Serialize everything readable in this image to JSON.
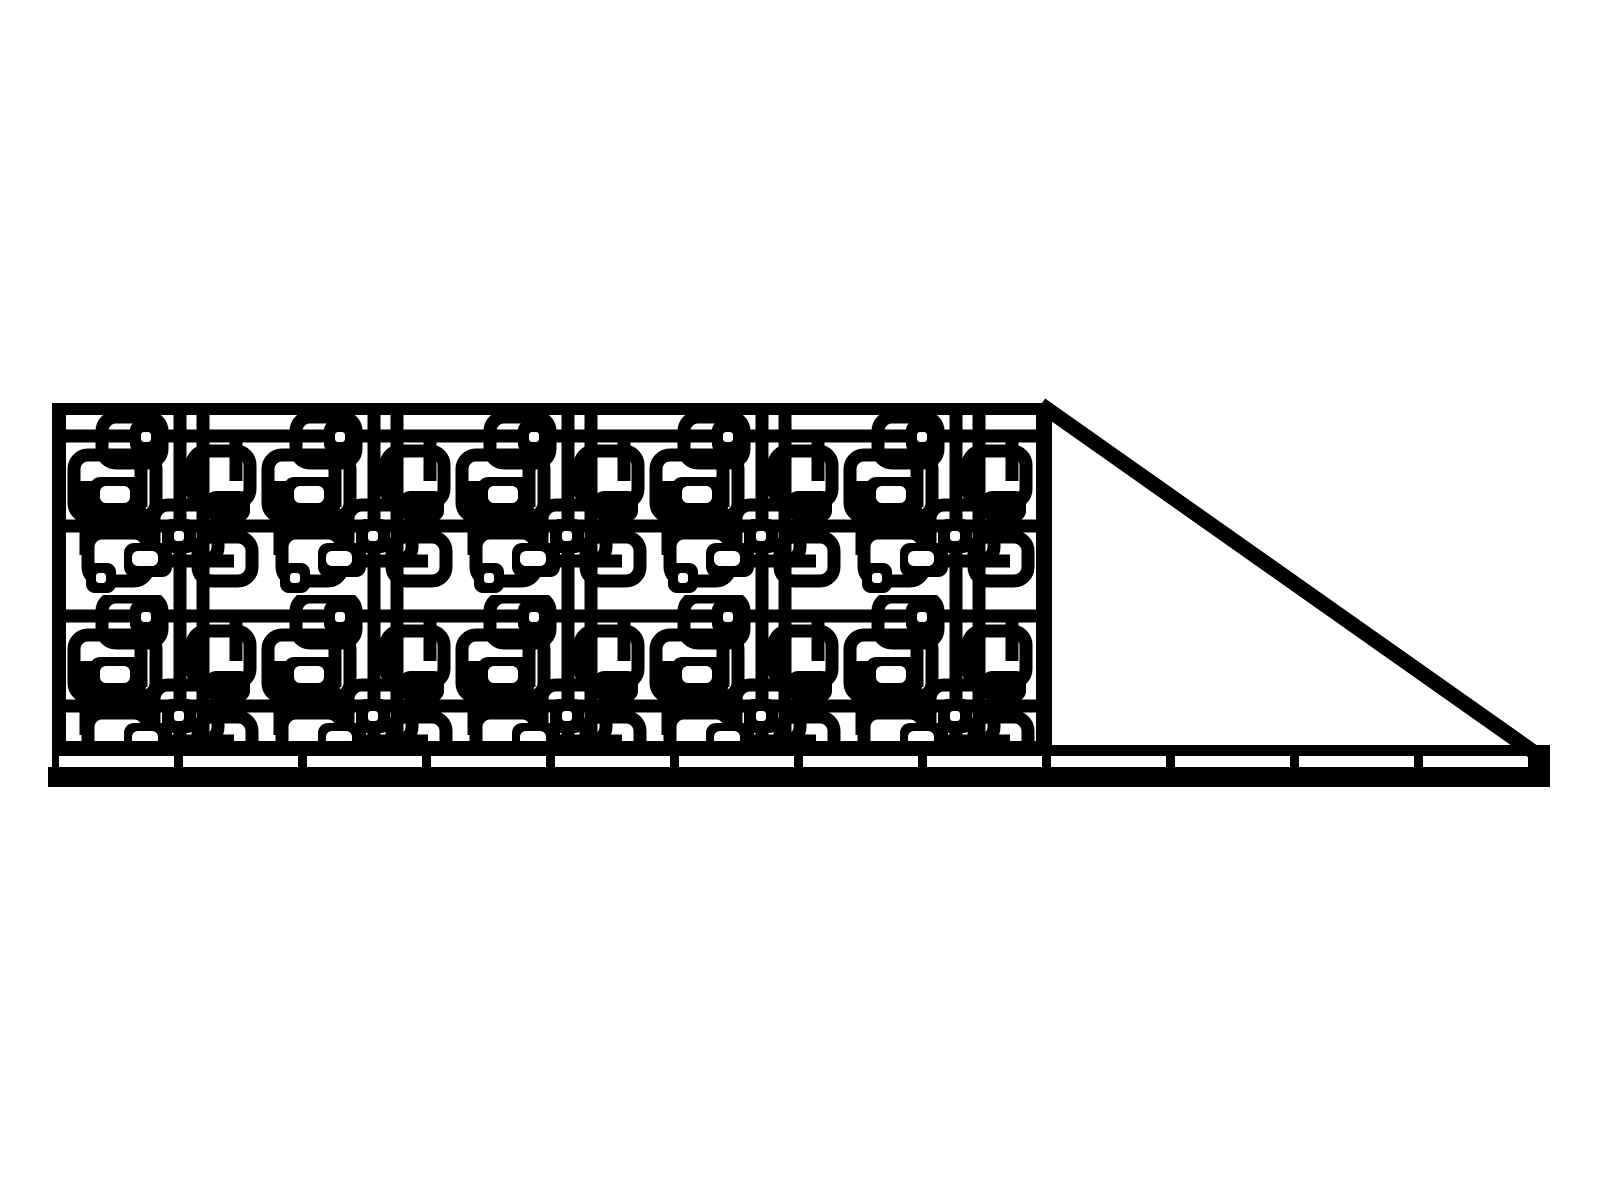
{
  "drawing": {
    "description": "Black and white laser-cut style drawing of a sliding driveway gate: a rectangular leaf filled with an interlocking rounded-square lattice pattern, a triangular diagonal tail brace on the right, and a segmented bottom guide track running the full width.",
    "colors": {
      "ink": "#000000",
      "background": "#ffffff"
    },
    "panel": {
      "name": "decorative-lattice-panel",
      "pattern_style": "interlocking rounded squares with small pierced squares",
      "tile_columns": 5,
      "tile_rows": 2
    },
    "brace": {
      "name": "diagonal-tail-brace"
    },
    "rail": {
      "name": "bottom-guide-track",
      "segment_count": 12,
      "divider_count": 11
    }
  }
}
